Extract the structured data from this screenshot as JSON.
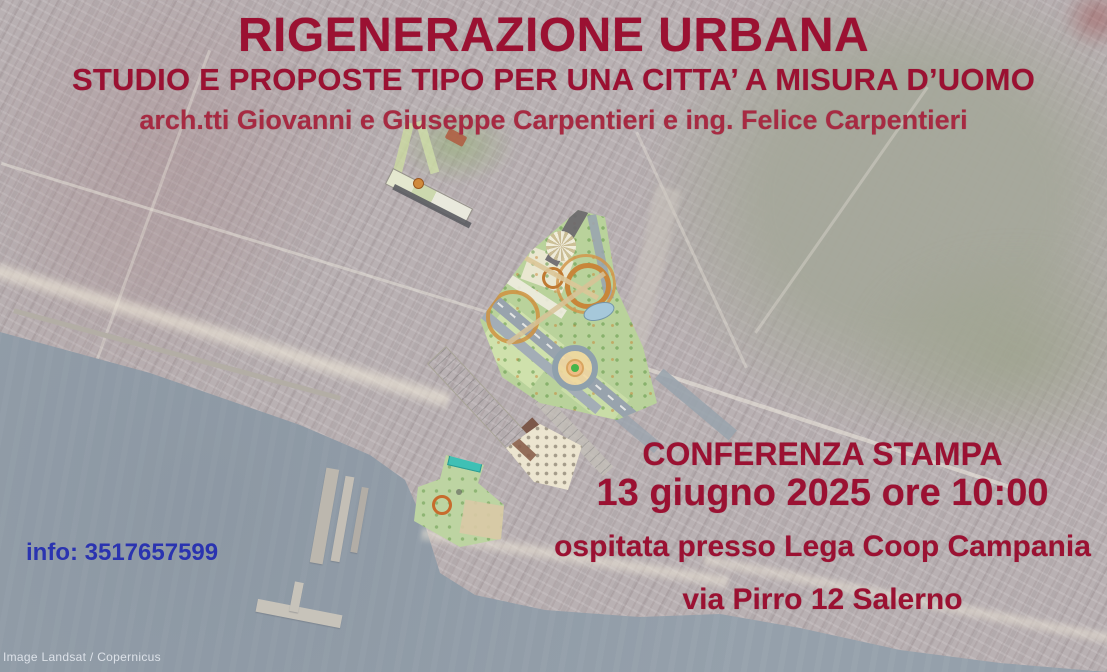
{
  "poster": {
    "title": "RIGENERAZIONE URBANA",
    "subtitle": "STUDIO E PROPOSTE TIPO PER UNA CITTA’ A MISURA D’UOMO",
    "authors": "arch.tti Giovanni e Giuseppe Carpentieri e ing. Felice Carpentieri",
    "event": {
      "label": "CONFERENZA STAMPA",
      "datetime": "13 giugno 2025 ore 10:00",
      "host": "ospitata presso Lega Coop Campania",
      "address": "via Pirro 12 Salerno"
    },
    "contact": "info: 3517657599",
    "attribution": "Image Landsat / Copernicus",
    "colors": {
      "title_red": "#9b1132",
      "authors_red": "#a72a42",
      "info_blue": "#2a33b0",
      "sea": "#95a0ab",
      "land": "#b9b1b3",
      "hills": "#a6a89b",
      "plan_green": "#b9d29b"
    }
  }
}
